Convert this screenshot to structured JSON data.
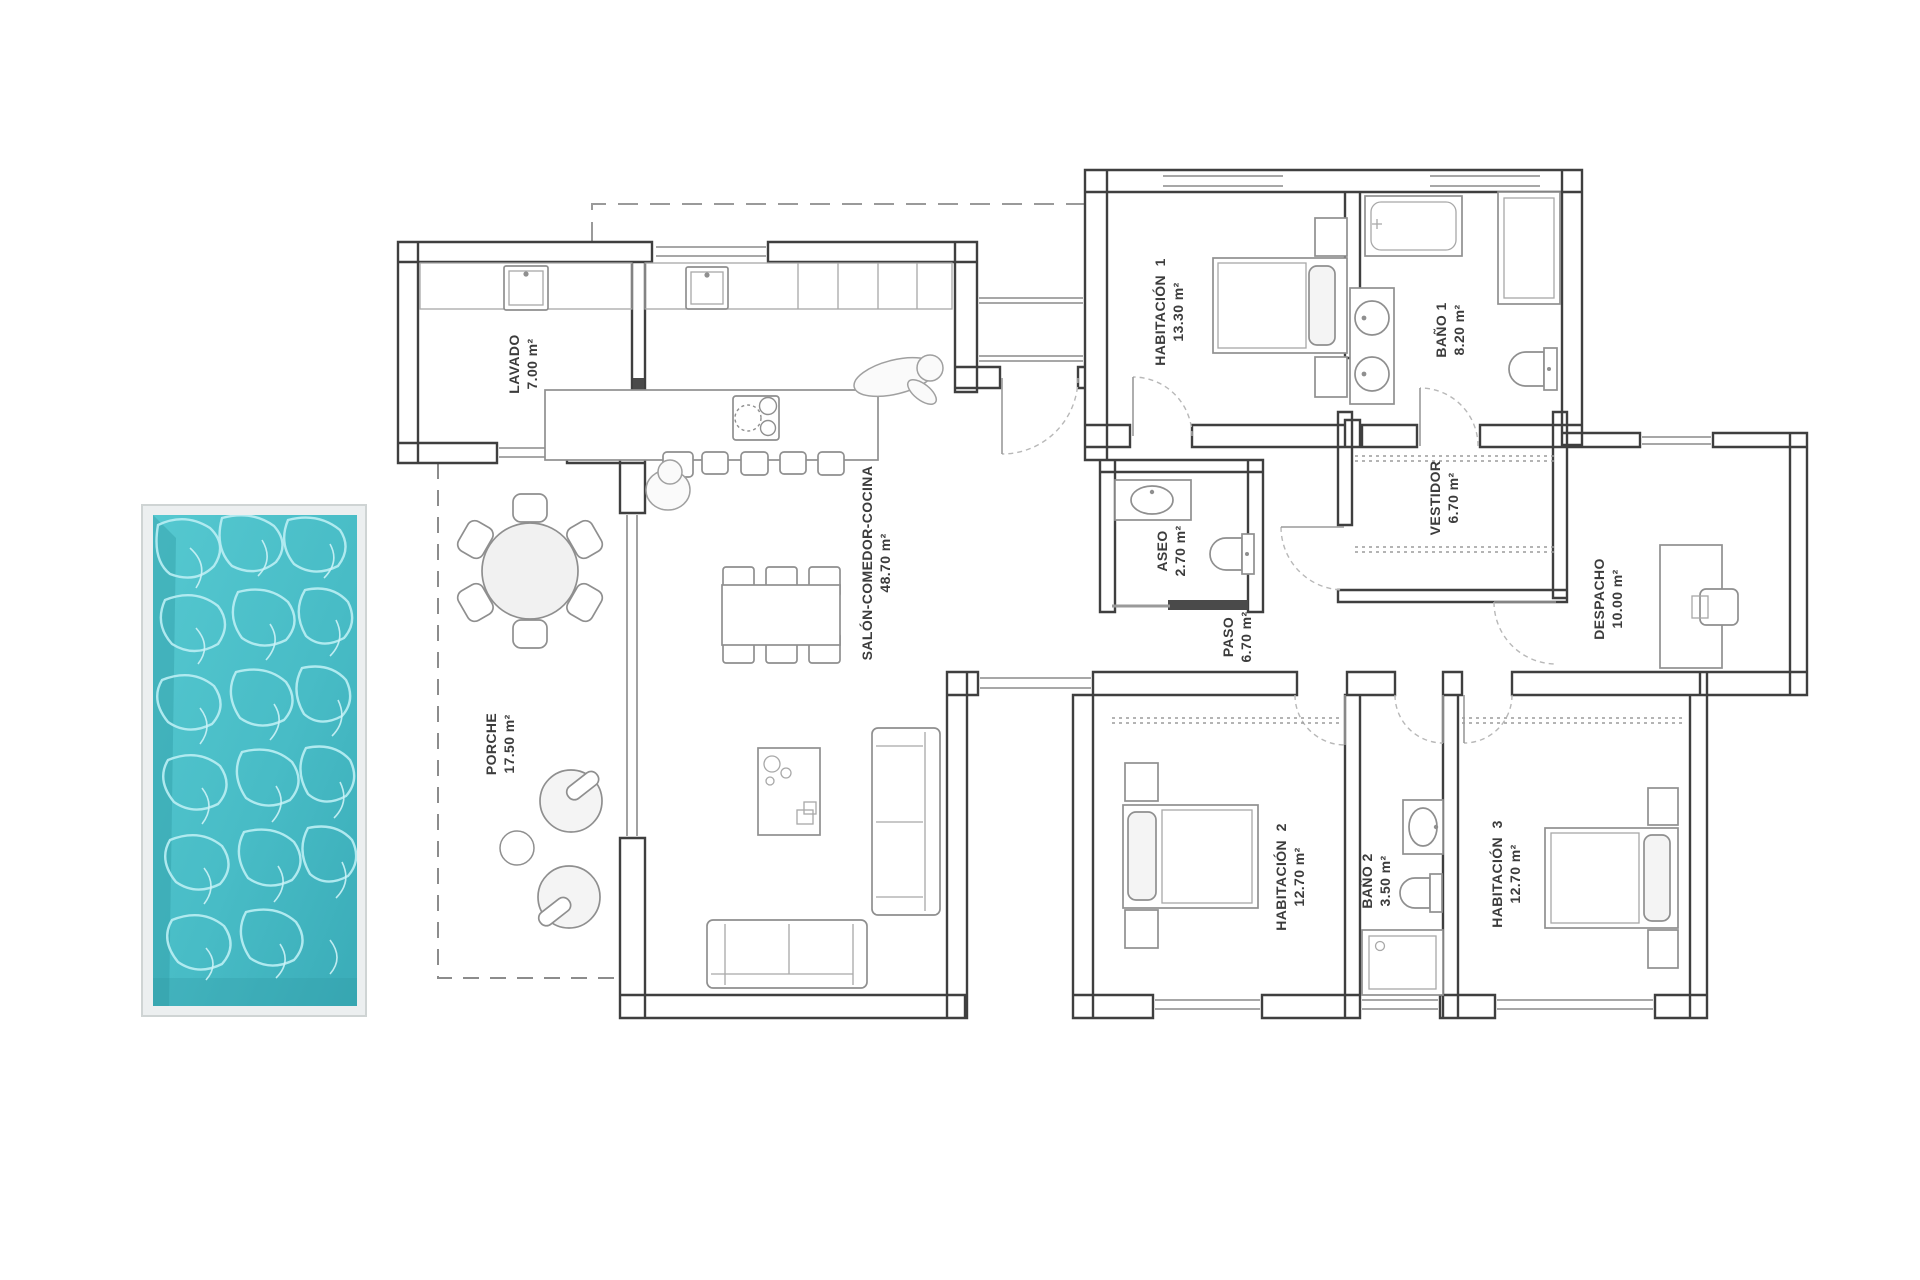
{
  "rooms": [
    {
      "id": "lavado",
      "label": "LAVADO",
      "area": "7.00 m²"
    },
    {
      "id": "salon-comedor-cocina",
      "label": "SALÓN-COMEDOR-COCINA",
      "area": "48.70 m²"
    },
    {
      "id": "porche",
      "label": "PORCHE",
      "area": "17.50 m²"
    },
    {
      "id": "habitacion-1",
      "label": "HABITACIÓN  1",
      "area": "13.30 m²"
    },
    {
      "id": "bano-1",
      "label": "BAÑO 1",
      "area": "8.20 m²"
    },
    {
      "id": "vestidor",
      "label": "VESTIDOR",
      "area": "6.70 m²"
    },
    {
      "id": "aseo",
      "label": "ASEO",
      "area": "2.70 m²"
    },
    {
      "id": "paso",
      "label": "PASO",
      "area": "6.70 m²"
    },
    {
      "id": "despacho",
      "label": "DESPACHO",
      "area": "10.00 m²"
    },
    {
      "id": "habitacion-2",
      "label": "HABITACIÓN  2",
      "area": "12.70 m²"
    },
    {
      "id": "bano-2",
      "label": "BAÑO 2",
      "area": "3.50 m²"
    },
    {
      "id": "habitacion-3",
      "label": "HABITACIÓN  3",
      "area": "12.70 m²"
    }
  ],
  "colors": {
    "pool_water": "#4cc0c9",
    "pool_water_deep": "#37a6b2",
    "pool_caustics": "#b5ecf1",
    "pool_frame": "#eceff0",
    "wall_line": "#3f3f3f",
    "furniture_line": "#8f8f8f",
    "label_text": "#3c3c3c"
  }
}
